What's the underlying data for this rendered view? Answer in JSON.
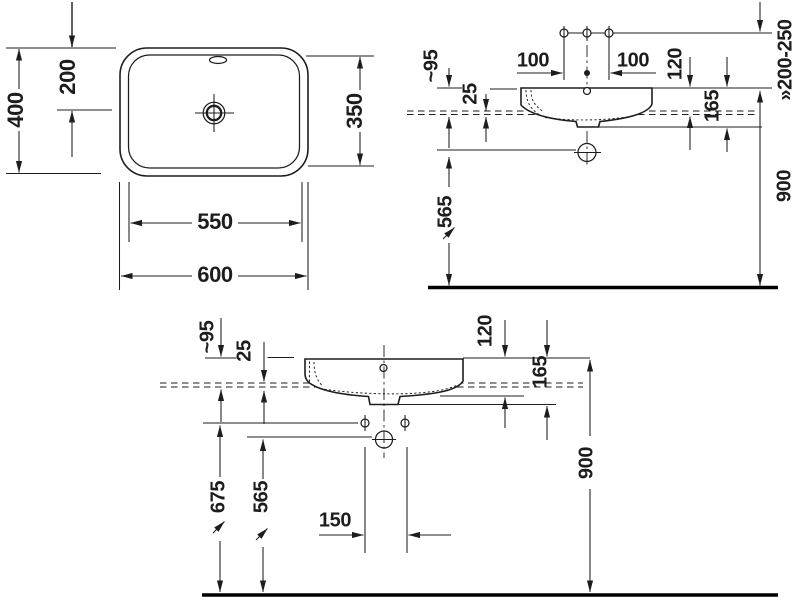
{
  "background": "#ffffff",
  "line_color": "#1d1d1b",
  "plan": {
    "dims": {
      "outer_width": "600",
      "inner_width": "550",
      "outer_depth": "400",
      "half_depth": "200",
      "inner_depth": "350"
    }
  },
  "wall": {
    "dims": {
      "tap_left": "100",
      "tap_right": "100",
      "spout": "~95",
      "rim": "25",
      "counter_drop": "120",
      "trap_drop": "165",
      "counter_clearance": "565",
      "rim_height": "900",
      "mixer_range": "»200-250"
    }
  },
  "front": {
    "dims": {
      "spout": "~95",
      "rim": "25",
      "counter_drop": "120",
      "trap_drop": "165",
      "fixing_height": "675",
      "drain_height": "565",
      "fixing_spacing": "150",
      "rim_height": "900"
    }
  }
}
